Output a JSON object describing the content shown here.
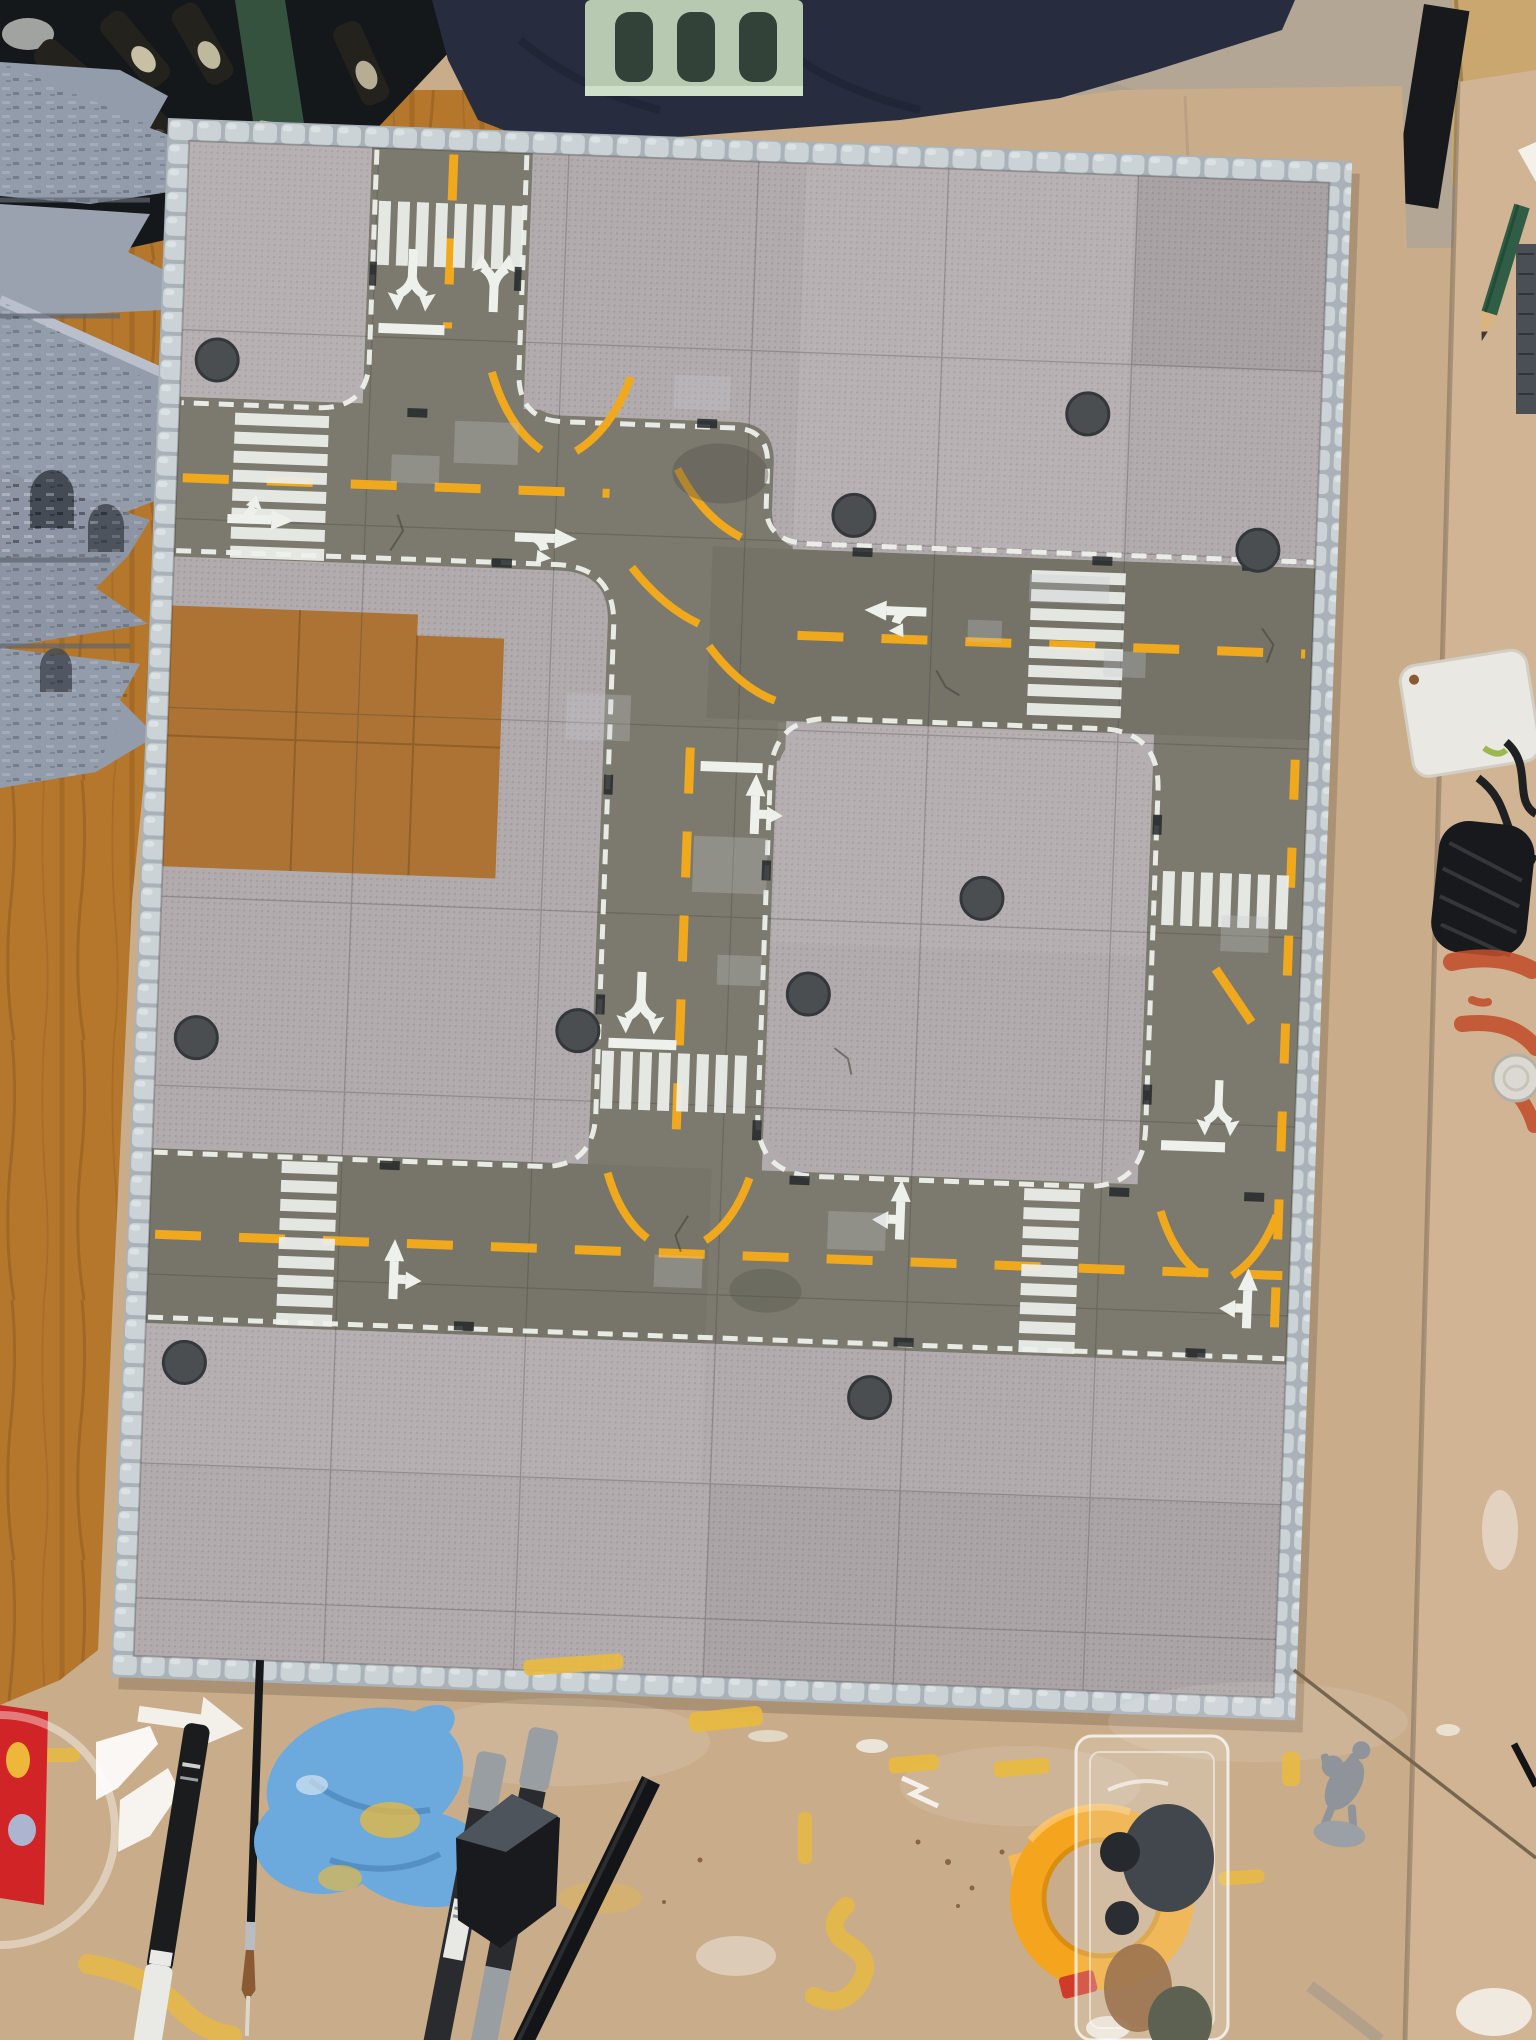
{
  "meta": {
    "scene_type": "photograph",
    "description": "Top-down photo of a modular miniature city-street gaming board under construction on a hobby workbench, surrounded by painting tools"
  },
  "palette": {
    "cardboard": "#c9ac8a",
    "cardboard_panel": "#d0b494",
    "wood": "#b5772c",
    "wood_deep": "#8a541c",
    "floor": "#b3a695",
    "fabric_navy": "#272c3e",
    "fabric_fold": "#1b2030",
    "shelf_dark": "#15181a",
    "shelf_green": "#35523f",
    "crate_green": "#b7cab1",
    "crate_slot": "#324238",
    "bottle_dark": "#23221d",
    "bottle_label": "#d9d2b4",
    "ruin_gray": "#939cab",
    "ruin_light": "#b9c0cc",
    "ruin_shadow": "#5f6671",
    "ruin_arch": "#454b55",
    "cobble": "#cbd3d7",
    "cobble_gap": "#a8b2b8",
    "plate": "#b2abad",
    "plate_light": "#c3bcbe",
    "plate_dark": "#a19a9d",
    "seam": "#3c3c3c",
    "asphalt": "#7c7a6e",
    "asphalt_dark": "#54524a",
    "mark_white": "#eef0eb",
    "mark_yellow": "#f0a81c",
    "manhole": "#4a4e51",
    "grate": "#25282a",
    "patch_gray": "#c6cad0",
    "mdf": "#ac7334",
    "mdf_line": "#7c4f1f",
    "glove_blue": "#6ca9dc",
    "glove_fold": "#4c86bb",
    "tub_red": "#d02426",
    "tape_orange": "#f5a41e",
    "tape_core": "#d98e12",
    "pen_black": "#1b1c1e",
    "cap_white": "#e9e9e5",
    "marker_body": "#2a2b2e",
    "marker_gray": "#989ea1",
    "brush_dark": "#17181a",
    "bristle": "#8a5a33",
    "ferrule": "#b9bcc0",
    "metal_rod": "#77664f",
    "mini_gray": "#8e949a",
    "paint_yellow": "#e9ba3e",
    "paint_white": "#f4f2ec",
    "paint_red": "#c24e2c",
    "charger_white": "#eae8e2",
    "cable_black": "#1f2022",
    "ribbed_black": "#17191c",
    "pencil_green": "#2f5d45",
    "pencil_wood": "#d9b47e",
    "blister_tint": "#ffffff"
  },
  "scene": {
    "board": {
      "kind": "modular street tile board",
      "border": "light gray cobblestone edging",
      "surfaces": [
        "studded sidewalk baseplates",
        "olive-gray asphalt road tiles",
        "bare brown MDF patch"
      ],
      "road_markings": [
        "dashed yellow center lines",
        "white dashed curb lines",
        "white zebra crosswalks",
        "white turn arrows",
        "white stop lines",
        "yellow guide arcs at intersections"
      ],
      "details": [
        "manhole covers",
        "drain grates",
        "gray repair patches",
        "cracks"
      ]
    },
    "objects": [
      {
        "name": "ruined-wall-stack",
        "desc": "stacked gray stone ruin terrain pieces on wooden table"
      },
      {
        "name": "beer-crate-shelf",
        "desc": "dark shelf with bottles behind table"
      },
      {
        "name": "green-plastic-crate",
        "desc": "light green bottle crate"
      },
      {
        "name": "navy-fabric",
        "desc": "dark blue fabric at top edge"
      },
      {
        "name": "floor-tile",
        "desc": "beige stone floor"
      },
      {
        "name": "cardboard-sheet",
        "desc": "large kraft cardboard underlay"
      },
      {
        "name": "cardboard-panel",
        "desc": "second cardboard panel at right"
      },
      {
        "name": "green-pencil",
        "desc": "sharpened green pencil"
      },
      {
        "name": "white-charger",
        "desc": "white power adapter with black cable"
      },
      {
        "name": "black-ribbed-object",
        "desc": "black ribbed rubber object"
      },
      {
        "name": "red-paint-smears",
        "desc": "red-orange brush smears"
      },
      {
        "name": "bottle-cap",
        "desc": "metal bottle cap"
      },
      {
        "name": "arrow-stencils",
        "desc": "white vinyl arrow stencils"
      },
      {
        "name": "paint-pen",
        "desc": "black paint pen with white cap"
      },
      {
        "name": "paintbrush",
        "desc": "long thin paintbrush"
      },
      {
        "name": "nitrile-glove",
        "desc": "blue glove with yellow paint stains"
      },
      {
        "name": "gray-markers",
        "desc": "two gray-capped paint markers"
      },
      {
        "name": "rubber-block",
        "desc": "black rubber block"
      },
      {
        "name": "styrene-strip",
        "desc": "long black plastic strip"
      },
      {
        "name": "masking-tape-roll",
        "desc": "orange masking tape roll"
      },
      {
        "name": "blister-palette",
        "desc": "clear blister pack used as paint palette"
      },
      {
        "name": "horse-miniature",
        "desc": "gray plastic mounted knight miniature"
      },
      {
        "name": "metal-rod",
        "desc": "long thin metal rod"
      },
      {
        "name": "paint-splatter",
        "desc": "yellow and white paint marks on cardboard"
      }
    ]
  }
}
